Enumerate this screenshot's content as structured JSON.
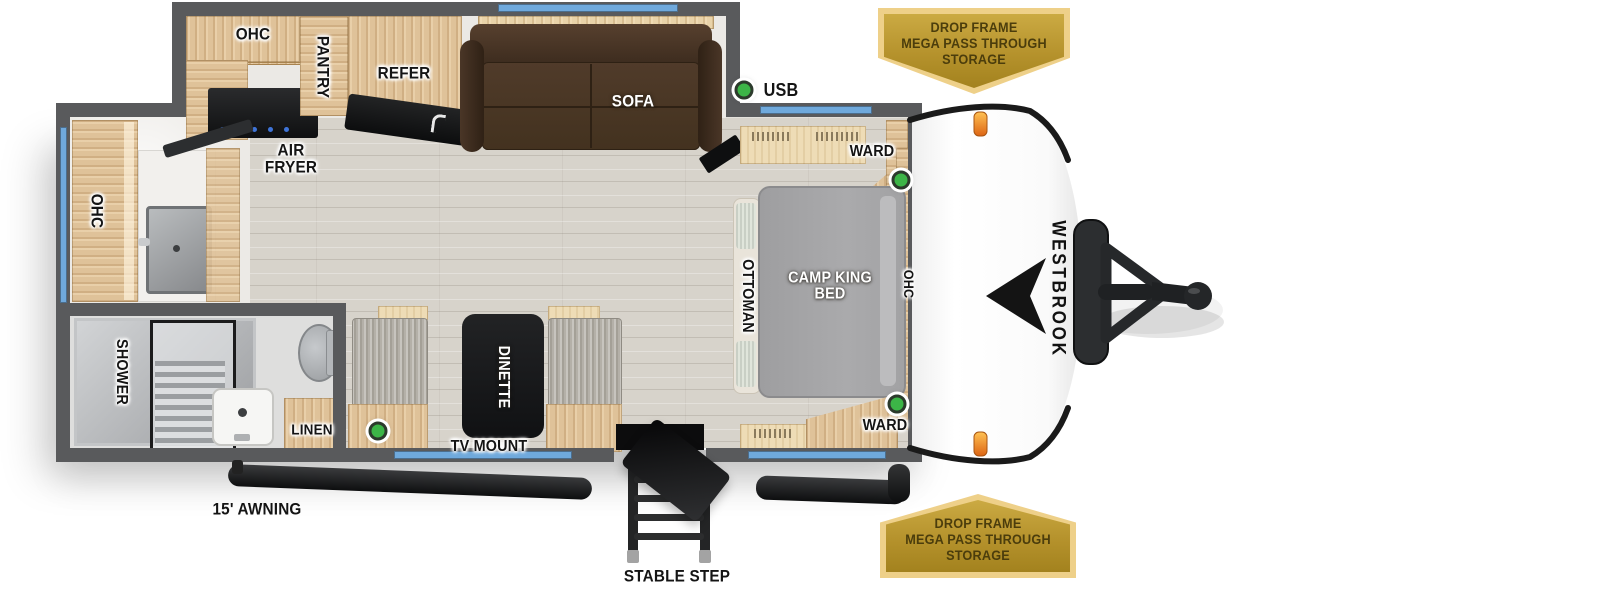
{
  "floorplan": {
    "kitchen": {
      "ohc": "OHC",
      "pantry": "PANTRY",
      "refer": "REFER",
      "air_fryer": "AIR FRYER",
      "sofa": "SOFA"
    },
    "bathroom": {
      "ohc": "OHC",
      "shower": "SHOWER",
      "linen": "LINEN"
    },
    "dinette": {
      "table": "DINETTE",
      "tv_mount": "TV MOUNT"
    },
    "bedroom": {
      "bed": "CAMP KING BED",
      "ottoman": "OTTOMAN",
      "ohc": "OHC",
      "ward_top": "WARD",
      "ward_bottom": "WARD",
      "usb": "USB"
    },
    "exterior": {
      "awning": "15' AWNING",
      "step": "STABLE STEP",
      "brand": "WESTBROOK"
    },
    "badges": {
      "top": [
        "DROP FRAME",
        "MEGA PASS THROUGH",
        "STORAGE"
      ],
      "bottom": [
        "DROP FRAME",
        "MEGA PASS THROUGH",
        "STORAGE"
      ]
    }
  },
  "colors": {
    "wall": "#595a5c",
    "window_blue": "#6fa9dc",
    "usb_dot_green": "#3cb547",
    "badge_gold_border": "#eed089",
    "badge_gold_fill": "#b5922c",
    "badge_text": "#4b3d0c",
    "sofa_brown": "#4a3627",
    "bed_gray": "#a6a6a8",
    "wood": "#dfc299",
    "floor": "#d7d3cb"
  }
}
